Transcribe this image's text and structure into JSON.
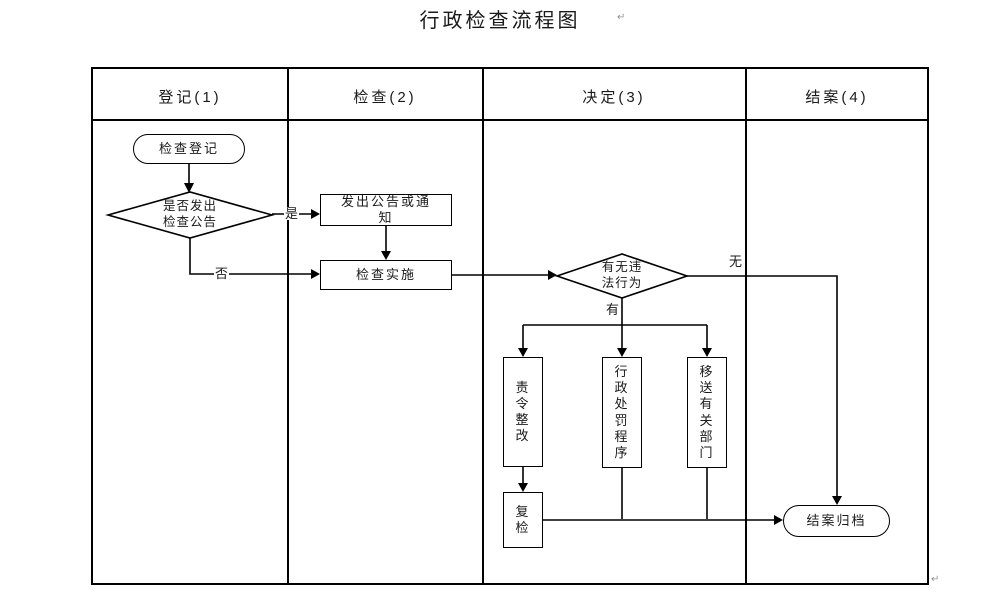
{
  "title": "行政检查流程图",
  "paragraph_mark": "↵",
  "lanes": [
    {
      "label": "登记(1)"
    },
    {
      "label": "检查(2)"
    },
    {
      "label": "决定(3)"
    },
    {
      "label": "结案(4)"
    }
  ],
  "nodes": {
    "start": "检查登记",
    "decision_notice": "是否发出\n检查公告",
    "issue_notice": "发出公告或通\n知",
    "implement": "检查实施",
    "decision_violation": "有无违\n法行为",
    "order_rectify": "责\n令\n整\n改",
    "punish_procedure": "行\n政\n处\n罚\n程\n序",
    "transfer_dept": "移\n送\n有\n关\n部\n门",
    "recheck": "复\n检",
    "close_archive": "结案归档"
  },
  "edge_labels": {
    "yes": "是",
    "no": "否",
    "has": "有",
    "none": "无"
  },
  "colors": {
    "line": "#000000",
    "background": "#ffffff",
    "text": "#1a1a1a"
  }
}
